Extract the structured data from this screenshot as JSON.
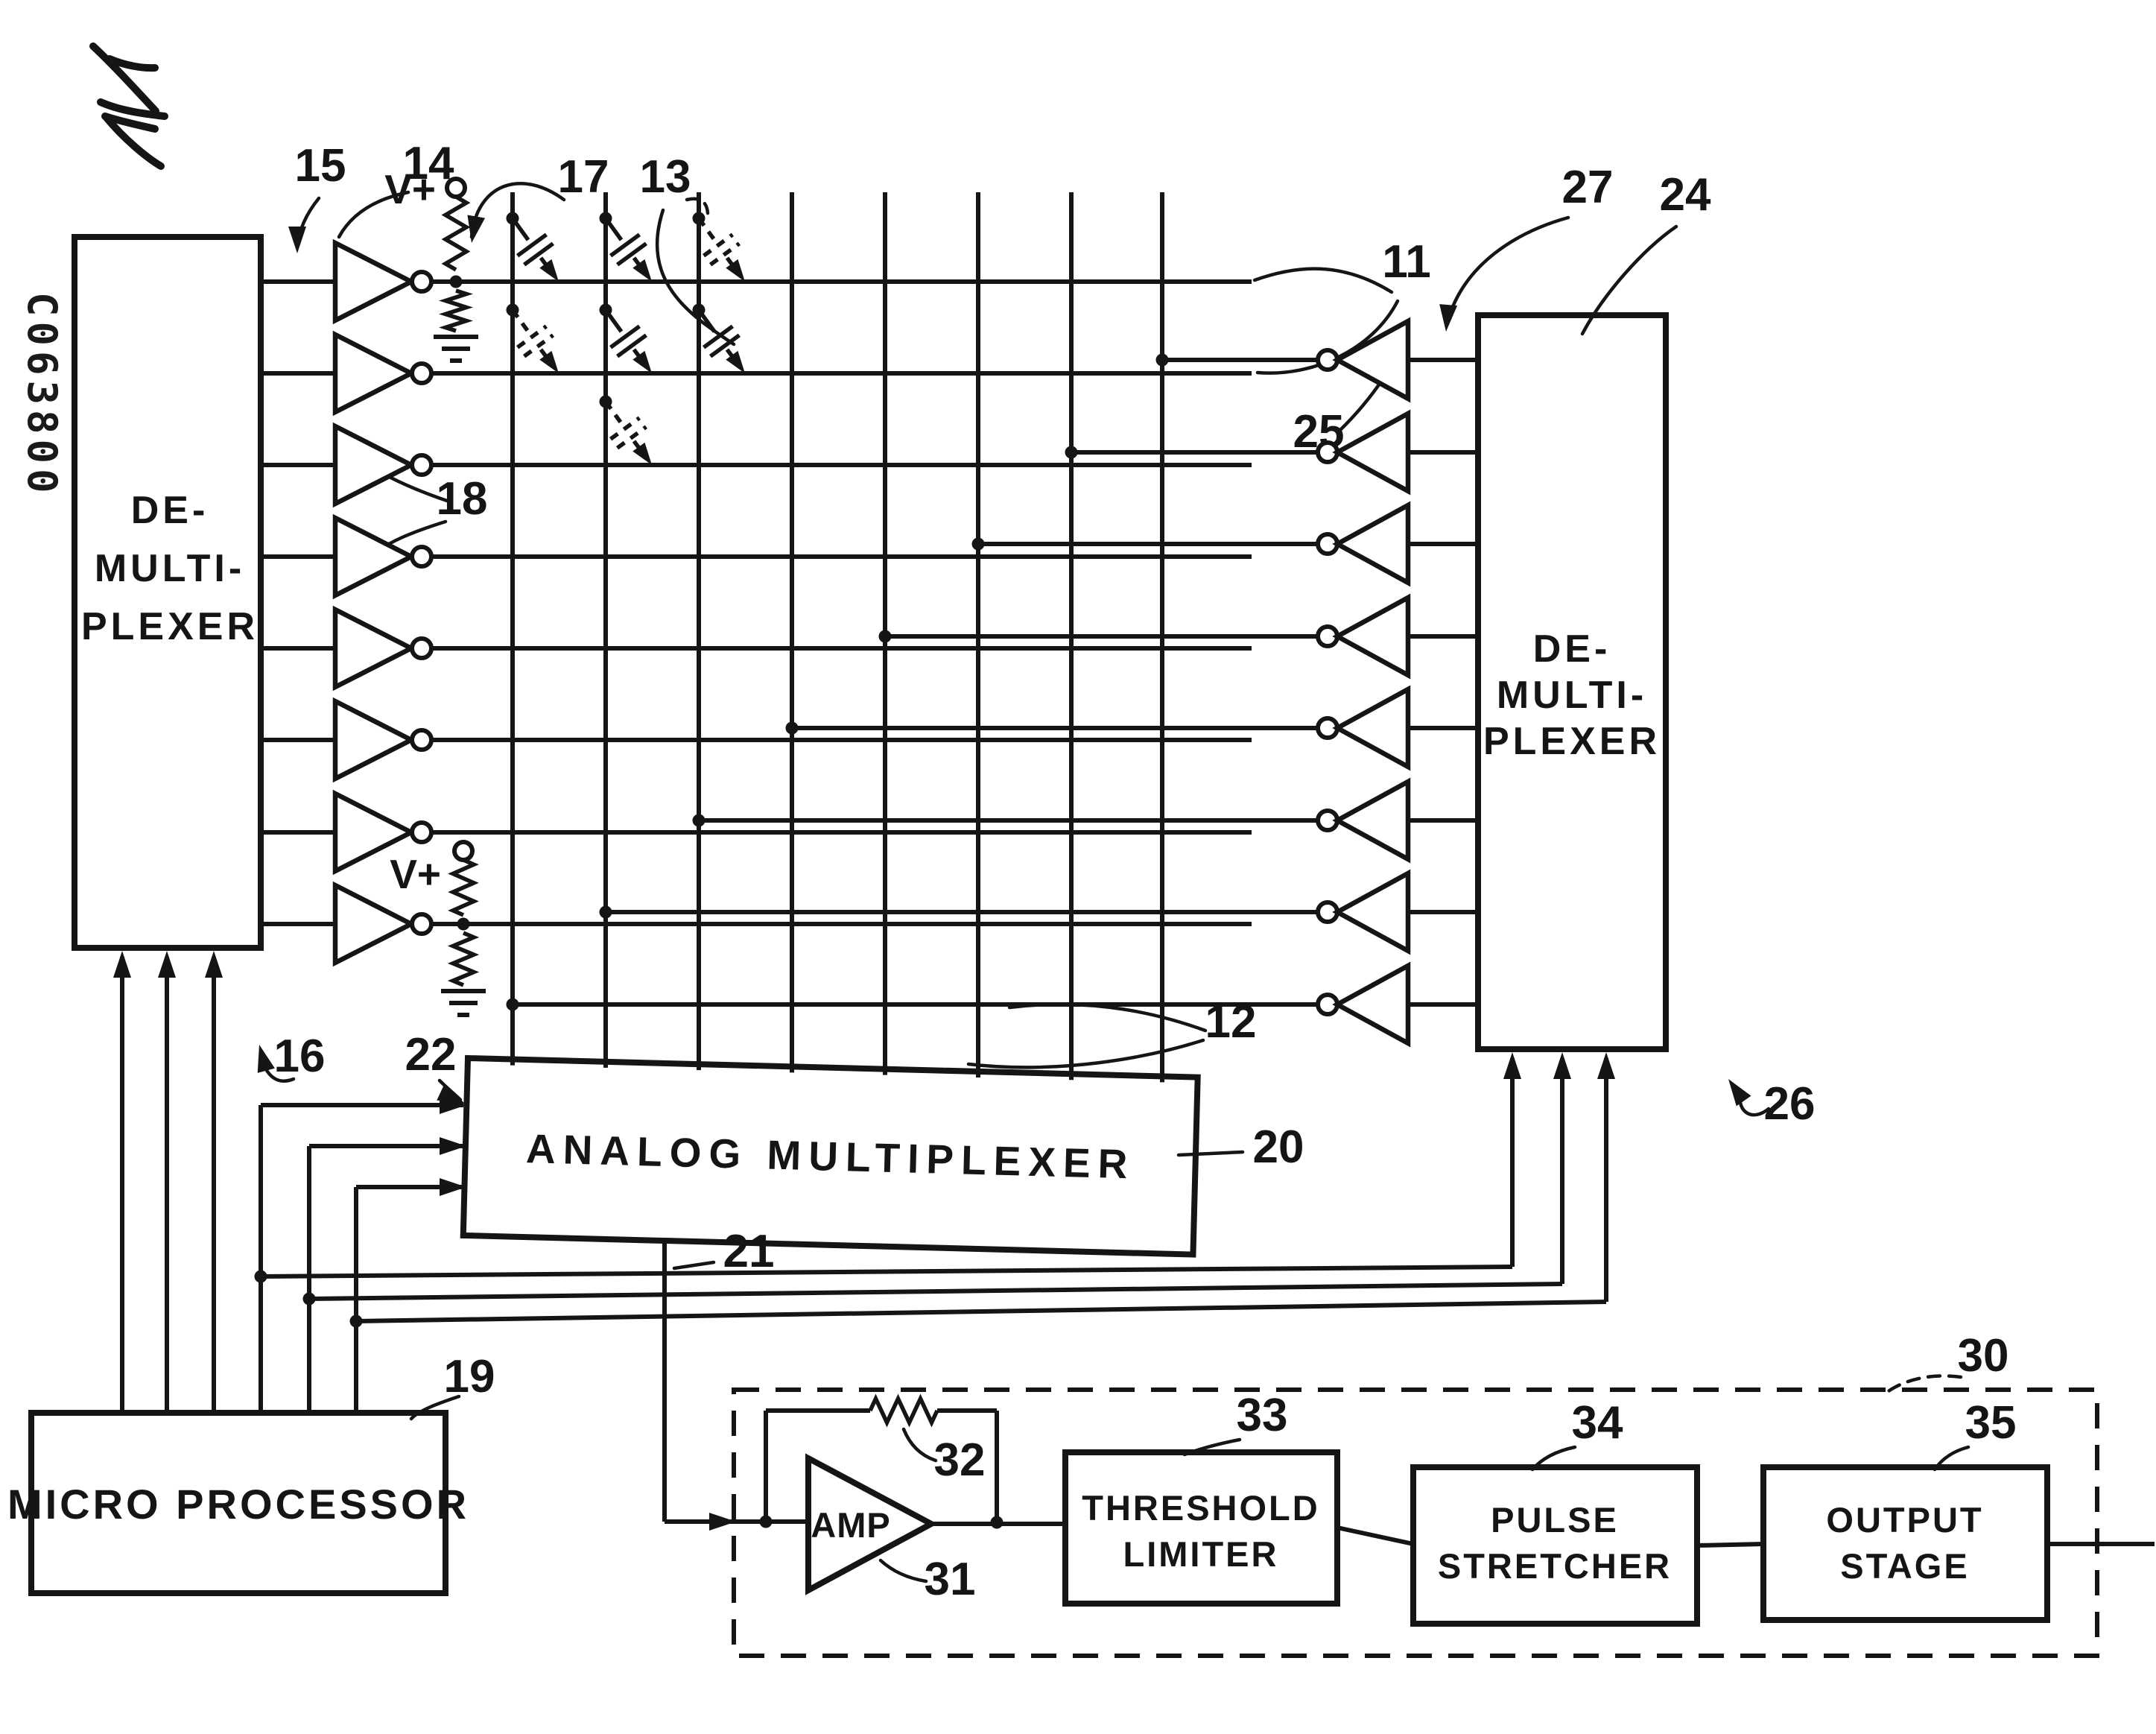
{
  "stamp": "C063800",
  "power": {
    "vplus_top": "V+",
    "vplus_bottom": "V+"
  },
  "blocks": {
    "left_demux": {
      "line1": "DE-",
      "line2": "MULTI-",
      "line3": "PLEXER"
    },
    "right_demux": {
      "line1": "DE-",
      "line2": "MULTI-",
      "line3": "PLEXER"
    },
    "analog_mux": {
      "label": "ANALOG  MULTIPLEXER"
    },
    "microprocessor": {
      "label": "MICRO PROCESSOR"
    },
    "amp": {
      "label": "AMP"
    },
    "threshold_limiter": {
      "line1": "THRESHOLD",
      "line2": "LIMITER"
    },
    "pulse_stretcher": {
      "line1": "PULSE",
      "line2": "STRETCHER"
    },
    "output_stage": {
      "line1": "OUTPUT",
      "line2": "STAGE"
    }
  },
  "refs": {
    "matrix_row_lines": "11",
    "matrix_column_lines": "12",
    "key_capacitors": "13",
    "left_demux": "14",
    "row_driver_input": "15",
    "mp_to_left_demux": "16",
    "pullup_resistor": "17",
    "row_buffers": "18",
    "microprocessor": "19",
    "analog_mux": "20",
    "mux_output": "21",
    "mp_to_mux": "22",
    "right_demux": "24",
    "column_inverters": "25",
    "mp_to_right_demux": "26",
    "right_demux_input": "27",
    "detector": "30",
    "amplifier": "31",
    "feedback_resistor": "32",
    "threshold_limiter": "33",
    "pulse_stretcher": "34",
    "output_stage": "35"
  }
}
